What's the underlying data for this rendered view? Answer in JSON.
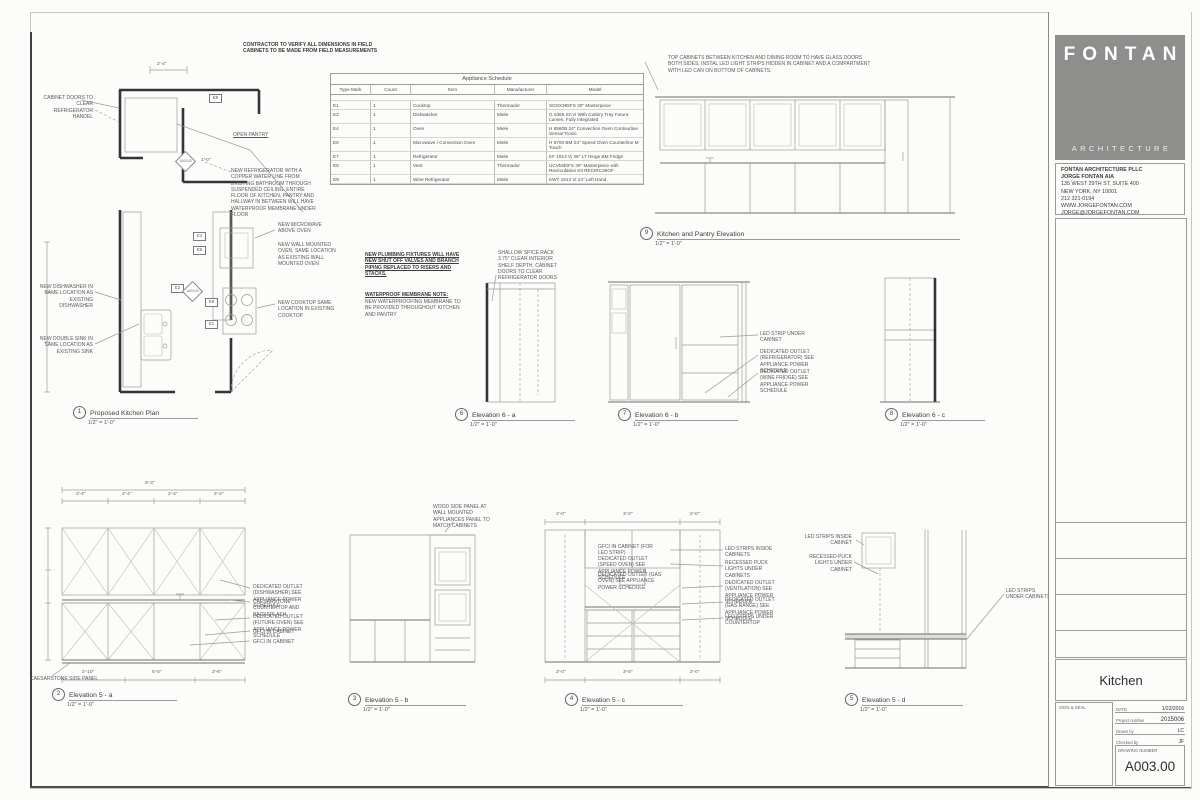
{
  "colors": {
    "logo_gray": "#8e8e8c",
    "line": "#9a9a98",
    "wall": "#343434",
    "text": "#4a4a4a"
  },
  "sheet_notes": {
    "general": "CONTRACTOR TO VERIFY ALL DIMENSIONS IN FIELD\nCABINETS TO BE MADE FROM FIELD MEASUREMENTS",
    "glass_cabinets": "TOP CABINETS BETWEEN KITCHEN AND DINING ROOM TO HAVE GLASS DOORS BOTH SIDES, INSTAL LED LIGHT STRIPS HIDDEN IN CABINET AND A COMPARTMENT WITH LED CAN ON BOTTOM OF CABINETS.",
    "plumbing": "NEW PLUMBING FIXTURES WILL HAVE NEW SHUT OFF VALVES AND BRANCH PIPING REPLACED TO RISERS AND STACKS.",
    "waterproof_title": "WATERPROOF MEMBRANE NOTE:",
    "waterproof_body": "NEW WATERPROOFING MEMBRANE TO BE PROVIDED THROUGHOUT KITCHEN AND PANTRY"
  },
  "schedule": {
    "title": "Appliance Schedule",
    "columns": [
      "Type Mark",
      "Count",
      "Item",
      "Manufacturer",
      "Model"
    ],
    "rows": [
      [
        "E1",
        "1",
        "Cooktop",
        "Thermador",
        "SGSX365FS 30\" Masterpiece"
      ],
      [
        "E2",
        "1",
        "Dishwasher",
        "Miele",
        "G 6365 SCVi With Cutlery Tray Futura Lumen, Fully Integrated"
      ],
      [
        "E4",
        "1",
        "Oven",
        "Miele",
        "H 6560B 24\" Convection Oven Contourline SensorTronic"
      ],
      [
        "E6",
        "1",
        "Microwave / Convection Oven",
        "Miele",
        "H 6700 BM 24\" Speed Oven Counterline M Touch"
      ],
      [
        "E7",
        "1",
        "Refrigerator",
        "Miele",
        "KF 1913 Vi 36\" LT Hinge BM Fridge"
      ],
      [
        "E8",
        "1",
        "Vent",
        "Thermador",
        "UCVM30FS 30\" Masterpiece with Recirculation Kit RECIRC36OF"
      ],
      [
        "E9",
        "1",
        "Wine Refrigerator",
        "Miele",
        "KWT 1613 Vi 24\" Left Hand"
      ]
    ]
  },
  "plan": {
    "num": "1",
    "title": "Proposed Kitchen Plan",
    "scale": "1/2\" = 1'-0\"",
    "marker": "A003.00",
    "tags": [
      "E9",
      "E4",
      "E6",
      "E2",
      "E8",
      "E1"
    ],
    "dims": {
      "top": "2'-4\"",
      "pantry": "1'-0\""
    },
    "notes": {
      "cabinet_doors": "CABINET DOORS TO CLEAR REFRIGERATOR HANDEL",
      "open_pantry": "OPEN PANTRY",
      "fridge": "NEW REFRIGERATOR WITH A COPPER WATER LINE FROM EXISTING BATHROOM THROUGH SUSPENDED CEILING. ENTIRE FLOOR OF KITCHEN, PANTRY AND HALLWAY IN BETWEEN WILL HAVE WATERPROOF MEMBRANE UNDER FLOOR",
      "microwave": "NEW MICROWAVE ABOVE OVEN",
      "wall_oven": "NEW WALL MOUNTED OVEN, SAME LOCATION AS EXISTING WALL MOUNTED OVEN",
      "dishwasher": "NEW DISHWASHER IN SAME LOCATION AS EXISTING DISHWASHER",
      "sink": "NEW DOUBLE SINK IN SAME LOCATION AS EXISTING SINK",
      "cooktop": "NEW COOKTOP SAME LOCATION IN EXISTING COOKTOP"
    }
  },
  "pantry": {
    "num": "9",
    "title": "Kitchen and Pantry Elevation",
    "scale": "1/2\" = 1'-0\""
  },
  "e6a": {
    "num": "6",
    "title": "Elevation 6 - a",
    "scale": "1/2\" = 1'-0\"",
    "notes": {
      "spice": "SHALLOW SPICE RACK 3.75\" CLEAR INTERIOR SHELF DEPTH. CABINET DOORS TO CLEAR REFRIGERATOR DOORS"
    }
  },
  "e6b": {
    "num": "7",
    "title": "Elevation 6 - b",
    "scale": "1/2\" = 1'-0\"",
    "notes": {
      "led": "LED STRIP UNDER CABINET",
      "outlet_fridge": "DEDICATED OUTLET (REFRIGERATOR) SEE APPLIANCE POWER SCHEDULE",
      "outlet_wine": "DEDICATED OUTLET (WINE FRIDGE) SEE APPLIANCE POWER SCHEDULE"
    }
  },
  "e6c": {
    "num": "8",
    "title": "Elevation 6 - c",
    "scale": "1/2\" = 1'-0\""
  },
  "e5a": {
    "num": "2",
    "title": "Elevation 5 - a",
    "scale": "1/2\" = 1'-0\"",
    "dims": {
      "overall": "9'-3\"",
      "seg": "2'-4\"",
      "b1": "2'-10\"",
      "b2": "5'-0\"",
      "b3": "2'-6\""
    },
    "notes": {
      "dw": "DEDICATED OUTLET (DISHWASHER) SEE APPLIANCE POWER SCHEDULE",
      "counter": "CAESARSTONE COUNTERTOP AND BACKSPLASH",
      "future": "DEDICATED OUTLET (FUTURE OVEN) SEE APPLIANCE POWER SCHEDULE",
      "gfci1": "GFCI IN CABINET",
      "gfci2": "GFCI IN CABINET",
      "side": "CAESARSTONE SIDE PANEL"
    }
  },
  "e5b": {
    "num": "3",
    "title": "Elevation 5 - b",
    "scale": "1/2\" = 1'-0\"",
    "notes": {
      "wood": "WOOD SIDE PANEL AT WALL MOUNTED APPLIANCES PANEL TO MATCH CABINETS"
    }
  },
  "e5c": {
    "num": "4",
    "title": "Elevation 5 - c",
    "scale": "1/2\" = 1'-0\"",
    "dims": {
      "t1": "2'-0\"",
      "t2": "3'-0\"",
      "t3": "2'-0\"",
      "b1": "2'-0\"",
      "b2": "3'-0\"",
      "b3": "2'-0\""
    },
    "notes": {
      "gfci": "GFCI IN CABINET (FOR LED STRIP)",
      "speed": "DEDICATED OUTLET (SPEED OVEN) SEE APPLIANCE POWER SCHEDULE",
      "gas_oven": "DEDICATED OUTLET (GAS OVEN) SEE APPLIANCE POWER SCHEDULE",
      "led_in": "LED STRIPS INSIDE CABINETS",
      "puck": "RECESSED PUCK LIGHTS UNDER CABINETS",
      "vent": "DEDICATED OUTLET (VENTILATION) SEE APPLIANCE POWER SCHEDULE",
      "range": "DEDICATED OUTLET (GAS RANGE) SEE APPLIANCE POWER SCHEDULE",
      "led_counter": "LED STRIPS UNDER COUNTERTOP"
    }
  },
  "e5d": {
    "num": "5",
    "title": "Elevation 5 - d",
    "scale": "1/2\" = 1'-0\"",
    "notes": {
      "led_in": "LED STRIPS INSIDE CABINET",
      "puck": "RECESSED PUCK LIGHTS UNDER CABINET",
      "led_under": "LED STRIPS UNDER CABINETS"
    }
  },
  "title_block": {
    "logo_main": "FONTAN",
    "logo_sub": "ARCHITECTURE",
    "firm_lines": [
      "FONTAN ARCHITECTURE PLLC",
      "JORGE FONTAN AIA",
      "135 WEST 29TH ST, SUITE 400",
      "NEW YORK, NY 10001",
      "212 321-0194",
      "WWW.JORGEFONTAN.COM",
      "JORGE@JORGEFONTAN.COM"
    ],
    "drawing_title": "Kitchen",
    "sign_seal": "SIGN & SEAL",
    "date_label": "DATE",
    "date": "1/22/2016",
    "project_label": "Project number",
    "project_number": "2015006",
    "drawn_label": "Drawn by",
    "drawn_by": "LC",
    "checked_label": "Checked by",
    "checked_by": "JF",
    "number_label": "DRAWING NUMBER",
    "drawing_number": "A003.00"
  }
}
